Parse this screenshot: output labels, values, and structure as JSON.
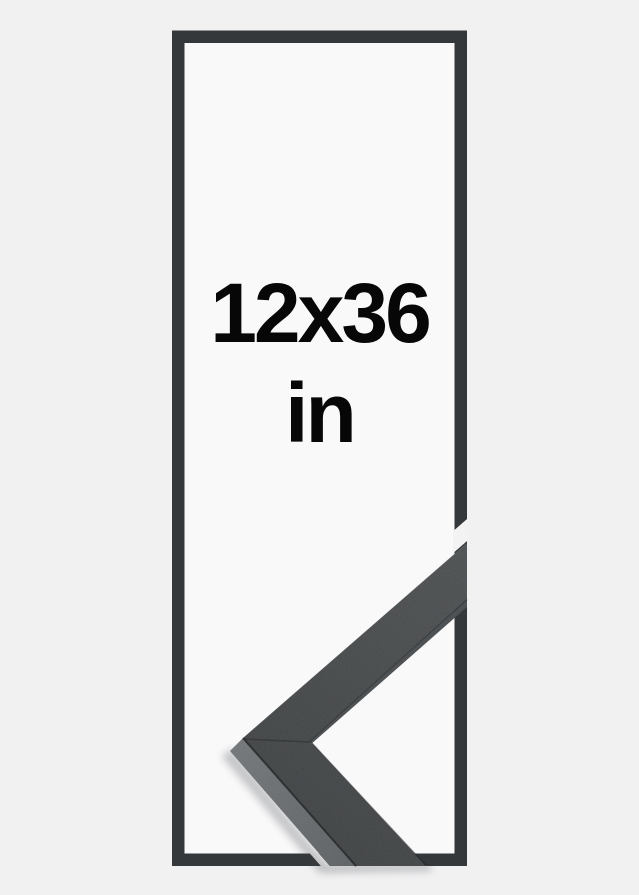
{
  "size_label": {
    "dimensions": "12x36",
    "unit": "in"
  },
  "colors": {
    "background": "#f1f1f2",
    "panel": "#f9f9fa",
    "outline": "#35383a",
    "label_text": "#070708",
    "frame_face": "#3b3e40",
    "frame_bevel": "#53575a"
  }
}
